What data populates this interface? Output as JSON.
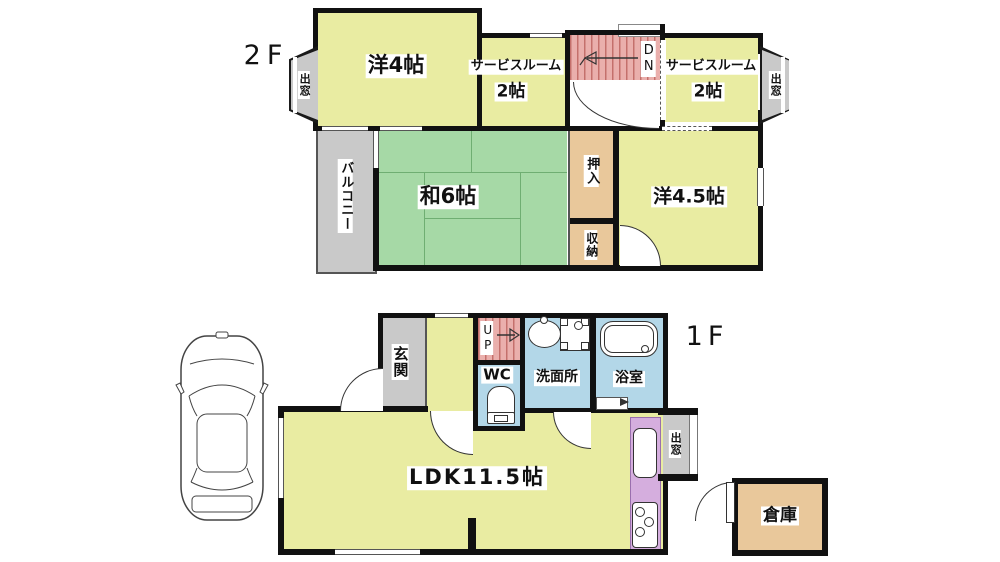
{
  "floor2": {
    "floor_label": "2F",
    "western_room_4": "洋4帖",
    "service_room_left_name": "サービスルーム",
    "service_room_left_size": "2帖",
    "service_room_right_name": "サービスルーム",
    "service_room_right_size": "2帖",
    "stairs_down": "DN",
    "japanese_room_6": "和6帖",
    "closet": "押入",
    "storage": "収納",
    "western_room_45": "洋4.5帖",
    "balcony": "バルコニー",
    "bay_window_left": "出窓",
    "bay_window_right": "出窓"
  },
  "floor1": {
    "floor_label": "1F",
    "entrance": "玄関",
    "stairs_up": "UP",
    "toilet": "WC",
    "washroom": "洗面所",
    "bathroom": "浴室",
    "ldk": "LDK11.5帖",
    "bay_window": "出窓",
    "warehouse": "倉庫"
  },
  "colors": {
    "wall": "#111111",
    "room_yellow": "#e9eca2",
    "tatami_green": "#a6d9a6",
    "closet_tan": "#e9c89b",
    "sanitary_blue": "#b3d7e8",
    "stairs_pink": "#eaafac",
    "stairs_stripe": "#c4706c",
    "kitchen_purple": "#d5aede",
    "balcony_gray": "#c9c9c9"
  }
}
